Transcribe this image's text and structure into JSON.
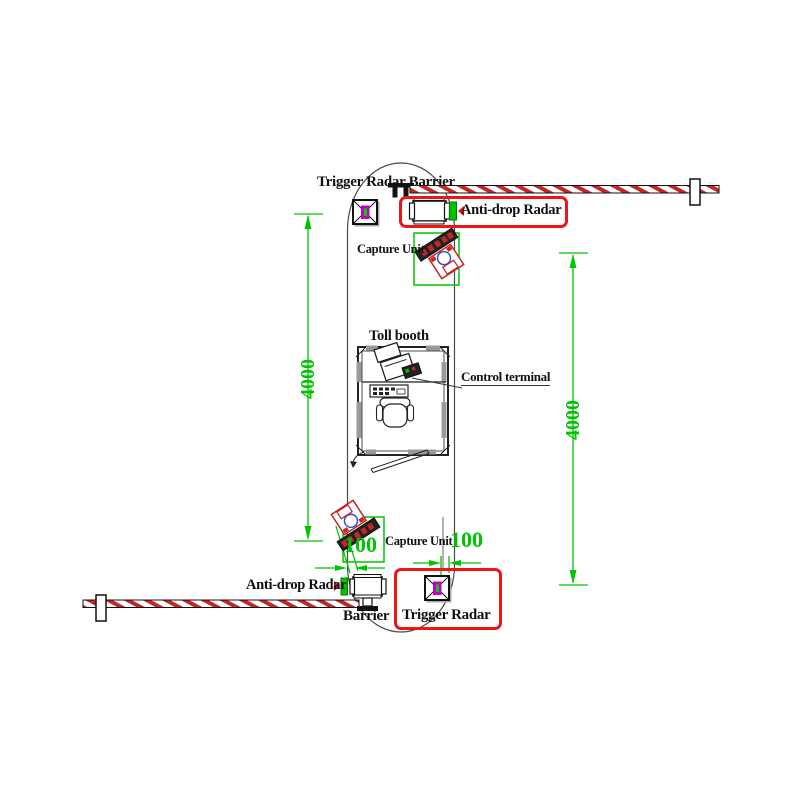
{
  "drawing_type": "toll-lane-equipment-layout",
  "labels": {
    "top": {
      "trigger_radar_barrier": "Trigger Radar Barrier",
      "anti_drop_radar": "Anti-drop Radar",
      "capture_unit": "Capture Unit"
    },
    "booth": {
      "toll_booth": "Toll booth",
      "control_terminal": "Control terminal"
    },
    "bottom": {
      "capture_unit": "Capture Unit",
      "anti_drop_radar": "Anti-drop Radar",
      "barrier": "Barrier",
      "trigger_radar": "Trigger Radar"
    }
  },
  "dimensions": {
    "left_lane_length": {
      "value": "4000",
      "orientation": "vertical"
    },
    "right_lane_length": {
      "value": "4000",
      "orientation": "vertical"
    },
    "capture_offset_left": {
      "value": "100",
      "orientation": "horizontal"
    },
    "capture_offset_right": {
      "value": "100",
      "orientation": "horizontal"
    }
  },
  "colors": {
    "dimension_green": "#00c400",
    "highlight_red": "#ed1515",
    "hatch_red": "#c22626",
    "radar_magenta": "#c400c4",
    "lens_blue": "#3a4ecc",
    "line_black": "#1a1a1a",
    "wall_gray": "#999999"
  }
}
